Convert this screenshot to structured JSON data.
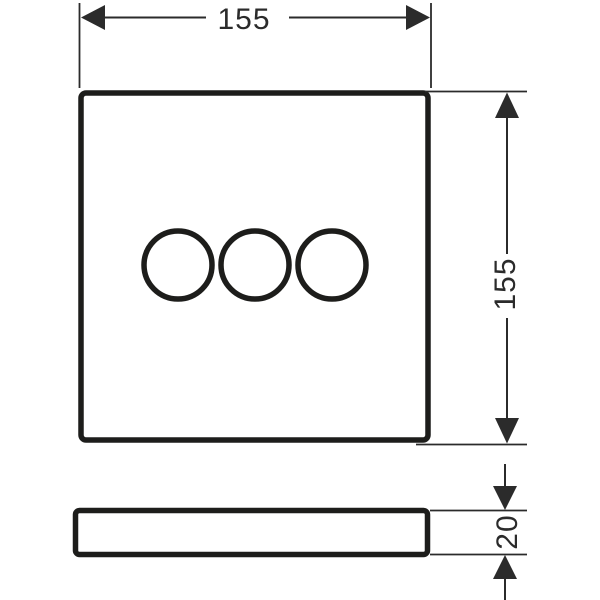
{
  "colors": {
    "line": "#1d1d1b",
    "dim": "#2b2b2b",
    "background": "#ffffff"
  },
  "dimensions": {
    "width": "155",
    "height": "155",
    "depth": "20"
  }
}
